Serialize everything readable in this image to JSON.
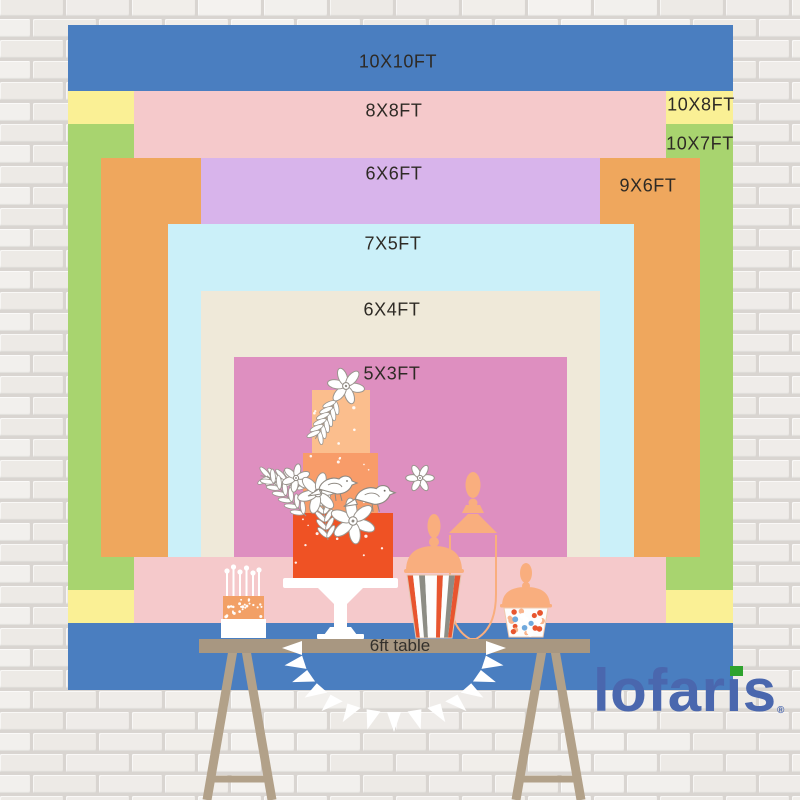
{
  "diagram": {
    "kind": "backdrop-size-comparison",
    "unit": "ft"
  },
  "colors": {
    "band_blue": "#4A7EC0",
    "band_yellow": "#FAF095",
    "band_green": "#A8D46F",
    "band_pink": "#F5C9CB",
    "band_orange": "#EFA75D",
    "band_purple": "#D8B4EB",
    "band_lightblue": "#CBF0F9",
    "band_beige": "#EFE9D9",
    "band_mauve": "#DE8FC0",
    "label_text": "#2E2A25",
    "table_tan": "#A89781",
    "leg_tan": "#B2A189",
    "cake_top": "#FBBE8D",
    "cake_middle": "#F89C69",
    "cake_bottom": "#EF5224",
    "jar_peach": "#F9AE7E",
    "candy_orange": "#E8552F",
    "stripe_gray": "#8D8D85",
    "logo_blue": "#4A67AE",
    "logo_green": "#2EA32E",
    "wall_mortar": "#D9D5D1"
  },
  "wall": {
    "brick_palette": [
      "#F2F0ED",
      "#EFECE9",
      "#F4F2EF",
      "#EDEAE6",
      "#F1EEEA"
    ]
  },
  "sizes": [
    {
      "id": "10x10ft",
      "label": "10X10FT",
      "width_ft": 10,
      "height_ft": 10,
      "color": "#4A7EC0",
      "rect": {
        "x": 68,
        "y": 25,
        "w": 665,
        "h": 665
      },
      "label_pos": {
        "x": 398,
        "y": 62
      }
    },
    {
      "id": "10x8ft",
      "label": "10X8FT",
      "width_ft": 10,
      "height_ft": 8,
      "color": "#FAF095",
      "rect": {
        "x": 68,
        "y": 91,
        "w": 665,
        "h": 532
      },
      "label_pos": {
        "x": 701,
        "y": 105
      }
    },
    {
      "id": "10x7ft",
      "label": "10X7FT",
      "width_ft": 10,
      "height_ft": 7,
      "color": "#A8D46F",
      "rect": {
        "x": 68,
        "y": 124,
        "w": 665,
        "h": 466
      },
      "label_pos": {
        "x": 700,
        "y": 144
      }
    },
    {
      "id": "8x8ft",
      "label": "8X8FT",
      "width_ft": 8,
      "height_ft": 8,
      "color": "#F5C9CB",
      "rect": {
        "x": 134,
        "y": 91,
        "w": 532,
        "h": 532
      },
      "label_pos": {
        "x": 394,
        "y": 111
      }
    },
    {
      "id": "9x6ft",
      "label": "9X6FT",
      "width_ft": 9,
      "height_ft": 6,
      "color": "#EFA75D",
      "rect": {
        "x": 101,
        "y": 158,
        "w": 599,
        "h": 399
      },
      "label_pos": {
        "x": 648,
        "y": 186
      }
    },
    {
      "id": "6x6ft",
      "label": "6X6FT",
      "width_ft": 6,
      "height_ft": 6,
      "color": "#D8B4EB",
      "rect": {
        "x": 201,
        "y": 158,
        "w": 399,
        "h": 399
      },
      "label_pos": {
        "x": 394,
        "y": 174
      }
    },
    {
      "id": "7x5ft",
      "label": "7X5FT",
      "width_ft": 7,
      "height_ft": 5,
      "color": "#CBF0F9",
      "rect": {
        "x": 168,
        "y": 224,
        "w": 466,
        "h": 333
      },
      "label_pos": {
        "x": 393,
        "y": 244
      }
    },
    {
      "id": "6x4ft",
      "label": "6X4FT",
      "width_ft": 6,
      "height_ft": 4,
      "color": "#EFE9D9",
      "rect": {
        "x": 201,
        "y": 291,
        "w": 399,
        "h": 266
      },
      "label_pos": {
        "x": 392,
        "y": 310
      }
    },
    {
      "id": "5x3ft",
      "label": "5X3FT",
      "width_ft": 5,
      "height_ft": 3,
      "color": "#DE8FC0",
      "rect": {
        "x": 234,
        "y": 357,
        "w": 333,
        "h": 200
      },
      "label_pos": {
        "x": 392,
        "y": 374
      }
    }
  ],
  "table": {
    "label": "6ft table",
    "length_ft": 6
  },
  "logo": {
    "text": "lofaris",
    "registered": "®"
  },
  "decor_icons": {
    "tiered_cake": "three-tier wedding cake with flowers and birds",
    "candle_dessert": "small cake with candles",
    "striped_candy_jar": "striped apothecary candy jar",
    "glass_jar_outline": "tall glass jar outline with peach lid",
    "candy_jar": "small jar filled with candies",
    "bunting": "white pennant garland",
    "trestle_table": "wooden trestle dessert table"
  }
}
